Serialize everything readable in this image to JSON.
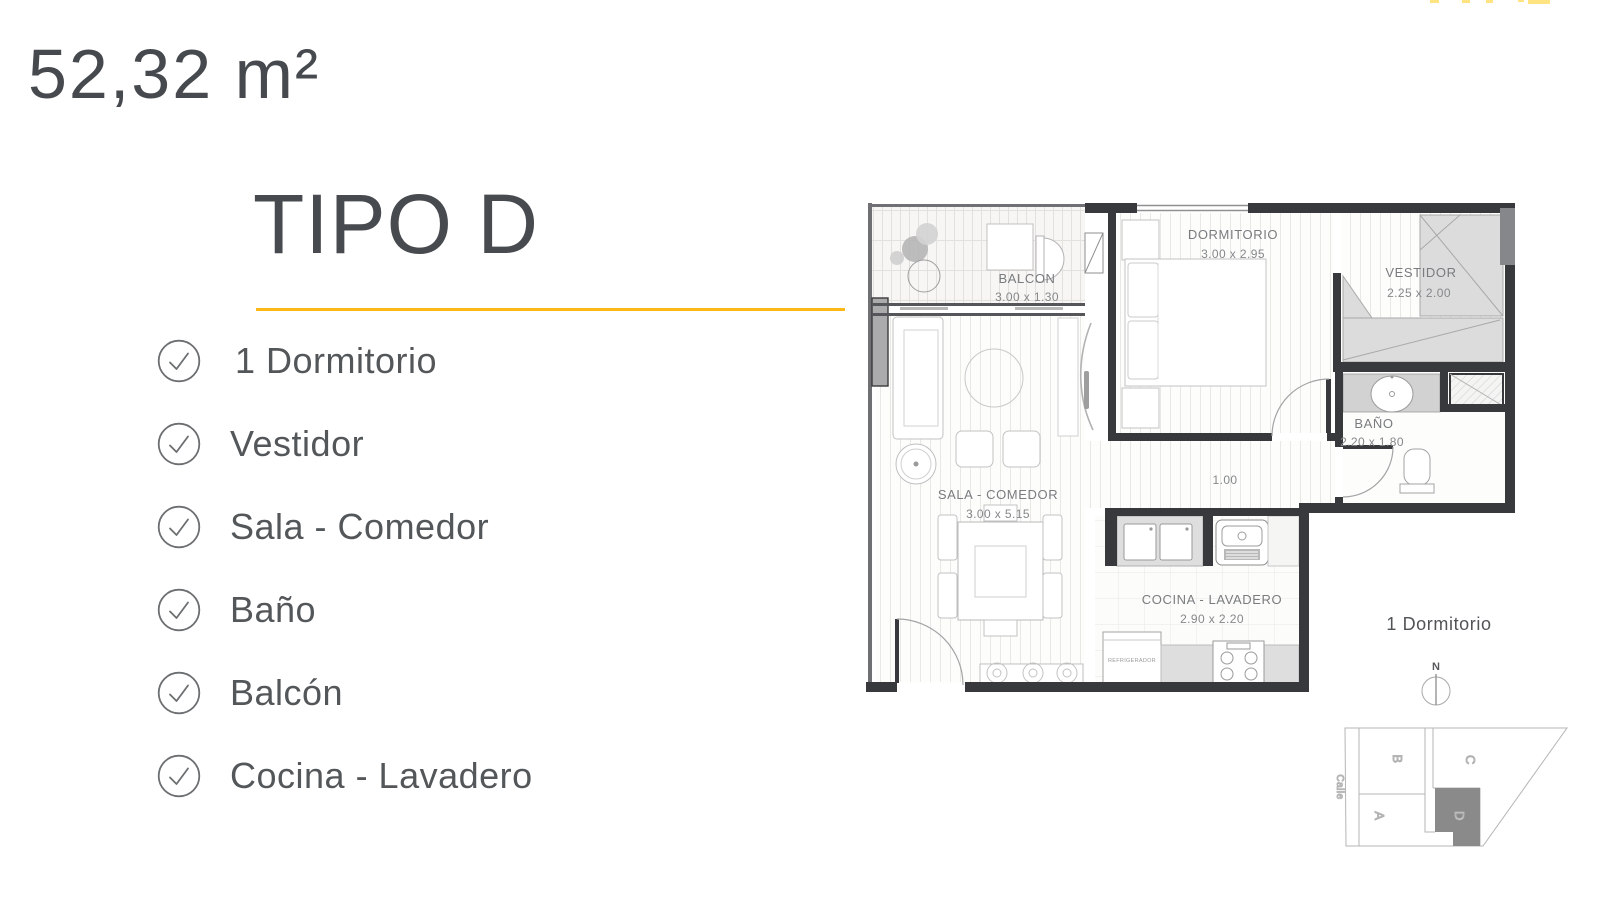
{
  "header": {
    "area_label": "52,32 m²"
  },
  "panel": {
    "title": "TIPO D",
    "accent_color": "#fcb817",
    "features": [
      {
        "label": "1 Dormitorio"
      },
      {
        "label": "Vestidor"
      },
      {
        "label": "Sala - Comedor"
      },
      {
        "label": "Baño"
      },
      {
        "label": "Balcón"
      },
      {
        "label": "Cocina - Lavadero"
      }
    ]
  },
  "floorplan": {
    "rooms": {
      "balcon": {
        "name": "BALCON",
        "dims": "3.00 x 1.30"
      },
      "dormitorio": {
        "name": "DORMITORIO",
        "dims": "3.00 x 2.95"
      },
      "vestidor": {
        "name": "VESTIDOR",
        "dims": "2.25 x 2.00"
      },
      "bano": {
        "name": "BAÑO",
        "dims": "2.20 x 1.80"
      },
      "sala": {
        "name": "SALA - COMEDOR",
        "dims": "3.00 x 5.15"
      },
      "cocina": {
        "name": "COCINA - LAVADERO",
        "dims": "2.90 x 2.20"
      }
    },
    "hall_dim": "1.00",
    "appliances": {
      "refrigerador": "REFRIGERADOR"
    },
    "caption": "1 Dormitorio",
    "compass": {
      "north_label": "N"
    },
    "siteplan": {
      "street_label": "Calle",
      "units": [
        "B",
        "C",
        "A",
        "D"
      ],
      "highlighted_unit": "D",
      "highlight_color": "#8a8a8a"
    }
  },
  "colors": {
    "heading_text": "#46494d",
    "list_text": "#54575a",
    "wall": "#38393d",
    "accent": "#fcb817"
  }
}
